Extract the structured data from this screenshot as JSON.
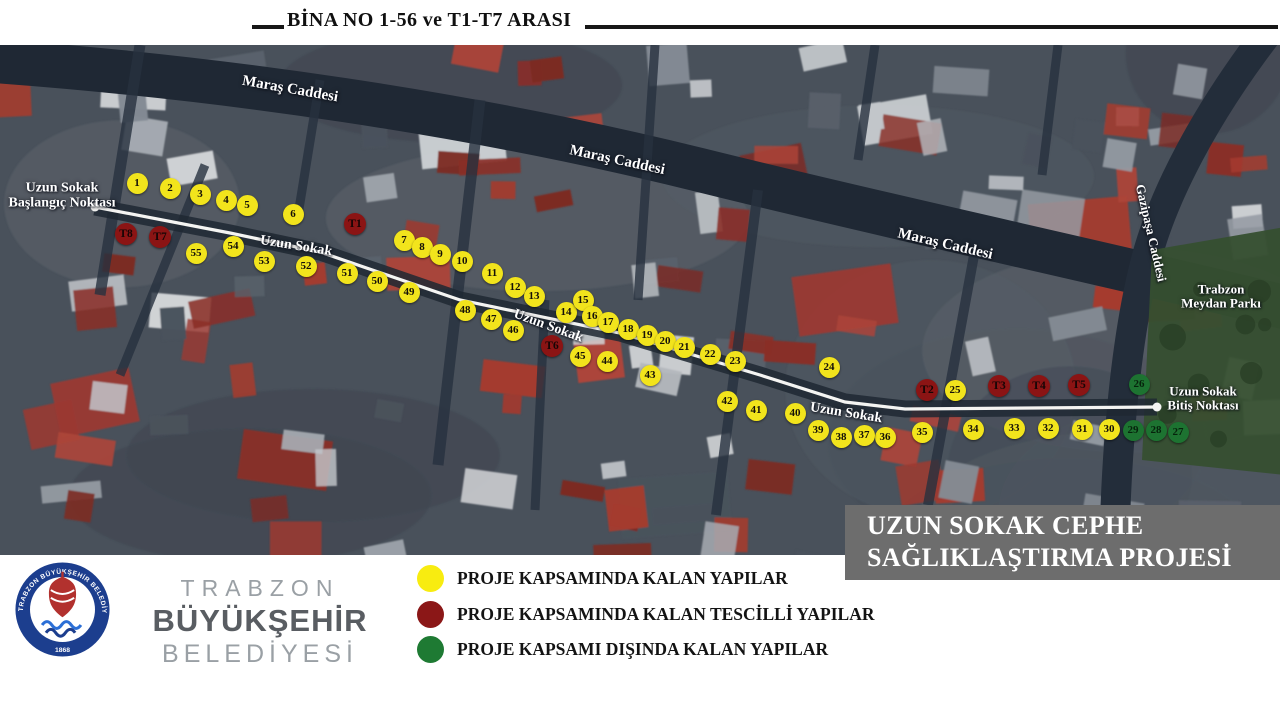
{
  "header": {
    "title": "BİNA NO 1-56 ve T1-T7 ARASI"
  },
  "map": {
    "street_labels": [
      {
        "text": "Maraş Caddesi",
        "x": 290,
        "y": 90,
        "rot": 10,
        "size": 15
      },
      {
        "text": "Maraş Caddesi",
        "x": 617,
        "y": 161,
        "rot": 12,
        "size": 15
      },
      {
        "text": "Maraş Caddesi",
        "x": 945,
        "y": 245,
        "rot": 13,
        "size": 15
      },
      {
        "text": "Uzun Sokak",
        "x": 296,
        "y": 247,
        "rot": 9,
        "size": 14
      },
      {
        "text": "Uzun Sokak",
        "x": 548,
        "y": 327,
        "rot": 20,
        "size": 14
      },
      {
        "text": "Uzun Sokak",
        "x": 846,
        "y": 414,
        "rot": 9,
        "size": 14
      },
      {
        "text": "Gazipaşa Caddesi",
        "x": 1151,
        "y": 233,
        "rot": 77,
        "size": 13
      },
      {
        "text": "Trabzon\nMeydan Parkı",
        "x": 1221,
        "y": 296,
        "rot": 0,
        "size": 13
      },
      {
        "text": "Uzun Sokak\nBaşlangıç Noktası",
        "x": 62,
        "y": 196,
        "rot": 0,
        "size": 14
      },
      {
        "text": "Uzun Sokak\nBitiş Noktası",
        "x": 1203,
        "y": 398,
        "rot": 0,
        "size": 13
      }
    ],
    "markers": [
      {
        "label": "1",
        "type": "yellow",
        "x": 137,
        "y": 183
      },
      {
        "label": "2",
        "type": "yellow",
        "x": 170,
        "y": 188
      },
      {
        "label": "3",
        "type": "yellow",
        "x": 200,
        "y": 194
      },
      {
        "label": "4",
        "type": "yellow",
        "x": 226,
        "y": 200
      },
      {
        "label": "5",
        "type": "yellow",
        "x": 247,
        "y": 205
      },
      {
        "label": "6",
        "type": "yellow",
        "x": 293,
        "y": 214
      },
      {
        "label": "7",
        "type": "yellow",
        "x": 404,
        "y": 240
      },
      {
        "label": "8",
        "type": "yellow",
        "x": 422,
        "y": 247
      },
      {
        "label": "9",
        "type": "yellow",
        "x": 440,
        "y": 254
      },
      {
        "label": "10",
        "type": "yellow",
        "x": 462,
        "y": 261
      },
      {
        "label": "11",
        "type": "yellow",
        "x": 492,
        "y": 273
      },
      {
        "label": "12",
        "type": "yellow",
        "x": 515,
        "y": 287
      },
      {
        "label": "13",
        "type": "yellow",
        "x": 534,
        "y": 296
      },
      {
        "label": "14",
        "type": "yellow",
        "x": 566,
        "y": 312
      },
      {
        "label": "15",
        "type": "yellow",
        "x": 583,
        "y": 300
      },
      {
        "label": "16",
        "type": "yellow",
        "x": 592,
        "y": 316
      },
      {
        "label": "17",
        "type": "yellow",
        "x": 608,
        "y": 322
      },
      {
        "label": "18",
        "type": "yellow",
        "x": 628,
        "y": 329
      },
      {
        "label": "19",
        "type": "yellow",
        "x": 647,
        "y": 335
      },
      {
        "label": "20",
        "type": "yellow",
        "x": 665,
        "y": 341
      },
      {
        "label": "21",
        "type": "yellow",
        "x": 684,
        "y": 347
      },
      {
        "label": "22",
        "type": "yellow",
        "x": 710,
        "y": 354
      },
      {
        "label": "23",
        "type": "yellow",
        "x": 735,
        "y": 361
      },
      {
        "label": "24",
        "type": "yellow",
        "x": 829,
        "y": 367
      },
      {
        "label": "25",
        "type": "yellow",
        "x": 955,
        "y": 390
      },
      {
        "label": "26",
        "type": "green",
        "x": 1139,
        "y": 384
      },
      {
        "label": "27",
        "type": "green",
        "x": 1178,
        "y": 432
      },
      {
        "label": "28",
        "type": "green",
        "x": 1156,
        "y": 430
      },
      {
        "label": "29",
        "type": "green",
        "x": 1133,
        "y": 430
      },
      {
        "label": "30",
        "type": "yellow",
        "x": 1109,
        "y": 429
      },
      {
        "label": "31",
        "type": "yellow",
        "x": 1082,
        "y": 429
      },
      {
        "label": "32",
        "type": "yellow",
        "x": 1048,
        "y": 428
      },
      {
        "label": "33",
        "type": "yellow",
        "x": 1014,
        "y": 428
      },
      {
        "label": "34",
        "type": "yellow",
        "x": 973,
        "y": 429
      },
      {
        "label": "35",
        "type": "yellow",
        "x": 922,
        "y": 432
      },
      {
        "label": "36",
        "type": "yellow",
        "x": 885,
        "y": 437
      },
      {
        "label": "37",
        "type": "yellow",
        "x": 864,
        "y": 435
      },
      {
        "label": "38",
        "type": "yellow",
        "x": 841,
        "y": 437
      },
      {
        "label": "39",
        "type": "yellow",
        "x": 818,
        "y": 430
      },
      {
        "label": "40",
        "type": "yellow",
        "x": 795,
        "y": 413
      },
      {
        "label": "41",
        "type": "yellow",
        "x": 756,
        "y": 410
      },
      {
        "label": "42",
        "type": "yellow",
        "x": 727,
        "y": 401
      },
      {
        "label": "43",
        "type": "yellow",
        "x": 650,
        "y": 375
      },
      {
        "label": "44",
        "type": "yellow",
        "x": 607,
        "y": 361
      },
      {
        "label": "45",
        "type": "yellow",
        "x": 580,
        "y": 356
      },
      {
        "label": "46",
        "type": "yellow",
        "x": 513,
        "y": 330
      },
      {
        "label": "47",
        "type": "yellow",
        "x": 491,
        "y": 319
      },
      {
        "label": "48",
        "type": "yellow",
        "x": 465,
        "y": 310
      },
      {
        "label": "49",
        "type": "yellow",
        "x": 409,
        "y": 292
      },
      {
        "label": "50",
        "type": "yellow",
        "x": 377,
        "y": 281
      },
      {
        "label": "51",
        "type": "yellow",
        "x": 347,
        "y": 273
      },
      {
        "label": "52",
        "type": "yellow",
        "x": 306,
        "y": 266
      },
      {
        "label": "53",
        "type": "yellow",
        "x": 264,
        "y": 261
      },
      {
        "label": "54",
        "type": "yellow",
        "x": 233,
        "y": 246
      },
      {
        "label": "55",
        "type": "yellow",
        "x": 196,
        "y": 253
      },
      {
        "label": "T1",
        "type": "red",
        "x": 355,
        "y": 224
      },
      {
        "label": "T2",
        "type": "red",
        "x": 927,
        "y": 390
      },
      {
        "label": "T3",
        "type": "red",
        "x": 999,
        "y": 386
      },
      {
        "label": "T4",
        "type": "red",
        "x": 1039,
        "y": 386
      },
      {
        "label": "T5",
        "type": "red",
        "x": 1079,
        "y": 385
      },
      {
        "label": "T6",
        "type": "red",
        "x": 552,
        "y": 346
      },
      {
        "label": "T7",
        "type": "red",
        "x": 160,
        "y": 237
      },
      {
        "label": "T8",
        "type": "red",
        "x": 126,
        "y": 234
      }
    ]
  },
  "project_box": {
    "line1": "UZUN SOKAK CEPHE",
    "line2": "SAĞLIKLAŞTIRMA PROJESİ"
  },
  "legend": {
    "items": [
      {
        "color": "#f8ec10",
        "label": "PROJE KAPSAMINDA KALAN YAPILAR"
      },
      {
        "color": "#8b1717",
        "label": "PROJE KAPSAMINDA KALAN TESCİLLİ YAPILAR"
      },
      {
        "color": "#1e7a33",
        "label": "PROJE KAPSAMI DIŞINDA KALAN YAPILAR"
      }
    ]
  },
  "footer_logo": {
    "ring_text": "TRABZON BÜYÜKŞEHİR BELEDİYESİ",
    "year": "1868",
    "line1": "TRABZON",
    "line2": "BÜYÜKŞEHİR",
    "line3": "BELEDİYESİ"
  },
  "colors": {
    "marker_yellow": "#f2e41c",
    "marker_red": "#8b1414",
    "marker_green": "#1d7331",
    "project_box_bg": "#6d6d6d",
    "logo_blue": "#1c3e8e",
    "logo_red": "#b2312e"
  }
}
